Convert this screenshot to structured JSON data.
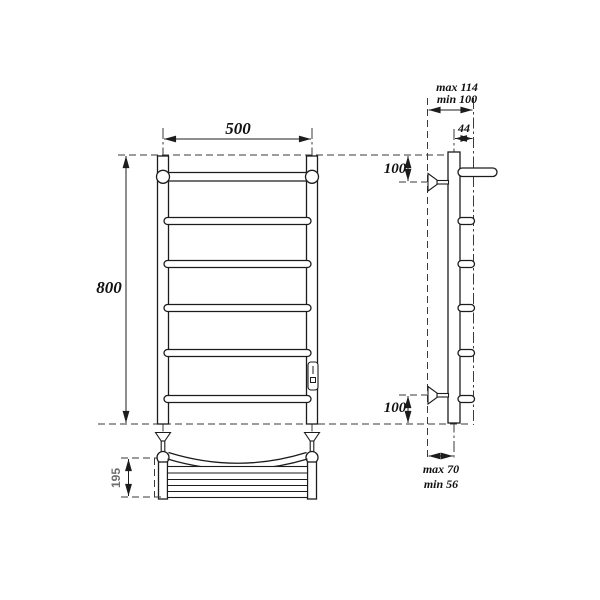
{
  "colors": {
    "line": "#1c1c1c",
    "dash": "#3a3a3a",
    "background": "#ffffff",
    "dim_text": "#111111",
    "shelf_dim_text": "#6e6e6e"
  },
  "front_view": {
    "dim_width": "500",
    "dim_height": "800",
    "dim_shelf_height": "195",
    "bar_count": 6
  },
  "side_view": {
    "dim_wall_offset_max": "max 114",
    "dim_wall_offset_min": "min 100",
    "dim_bar_offset": "44",
    "dim_top_mount": "100",
    "dim_bottom_mount": "100",
    "dim_lower_depth_max": "max 70",
    "dim_lower_depth_min": "min 56"
  }
}
